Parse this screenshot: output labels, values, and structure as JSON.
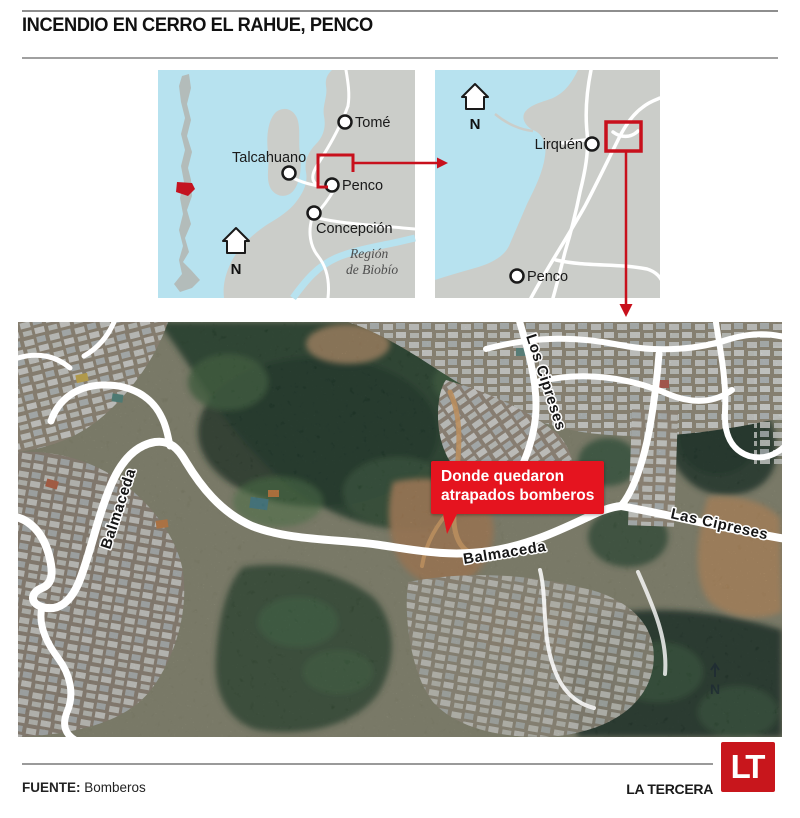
{
  "header": {
    "title": "INCENDIO EN CERRO EL RAHUE, PENCO"
  },
  "overview_map": {
    "cities": {
      "tome": "Tomé",
      "talcahuano": "Talcahuano",
      "penco": "Penco",
      "concepcion": "Concepción"
    },
    "region_line1": "Región",
    "region_line2": "de Biobío",
    "north": "N"
  },
  "detail_map": {
    "cities": {
      "lirquen": "Lirquén",
      "penco": "Penco"
    },
    "north": "N"
  },
  "satellite_map": {
    "road_labels": {
      "los_cipreses": "Los Cipreses",
      "las_cipreses": "Las Cipreses",
      "balmaceda_left": "Balmaceda",
      "balmaceda_bottom": "Balmaceda"
    },
    "callout": {
      "line1": "Donde quedaron",
      "line2": "atrapados bomberos"
    },
    "north": "N"
  },
  "footer": {
    "source_label": "FUENTE:",
    "source_value": "Bomberos",
    "brand": "LA TERCERA",
    "logo": "LT"
  },
  "colors": {
    "accent_red": "#c8101c",
    "callout_red": "#e5141f",
    "logo_red": "#c8161c",
    "water_blue": "#b7e2ef",
    "land_gray": "#cbcdc9"
  }
}
